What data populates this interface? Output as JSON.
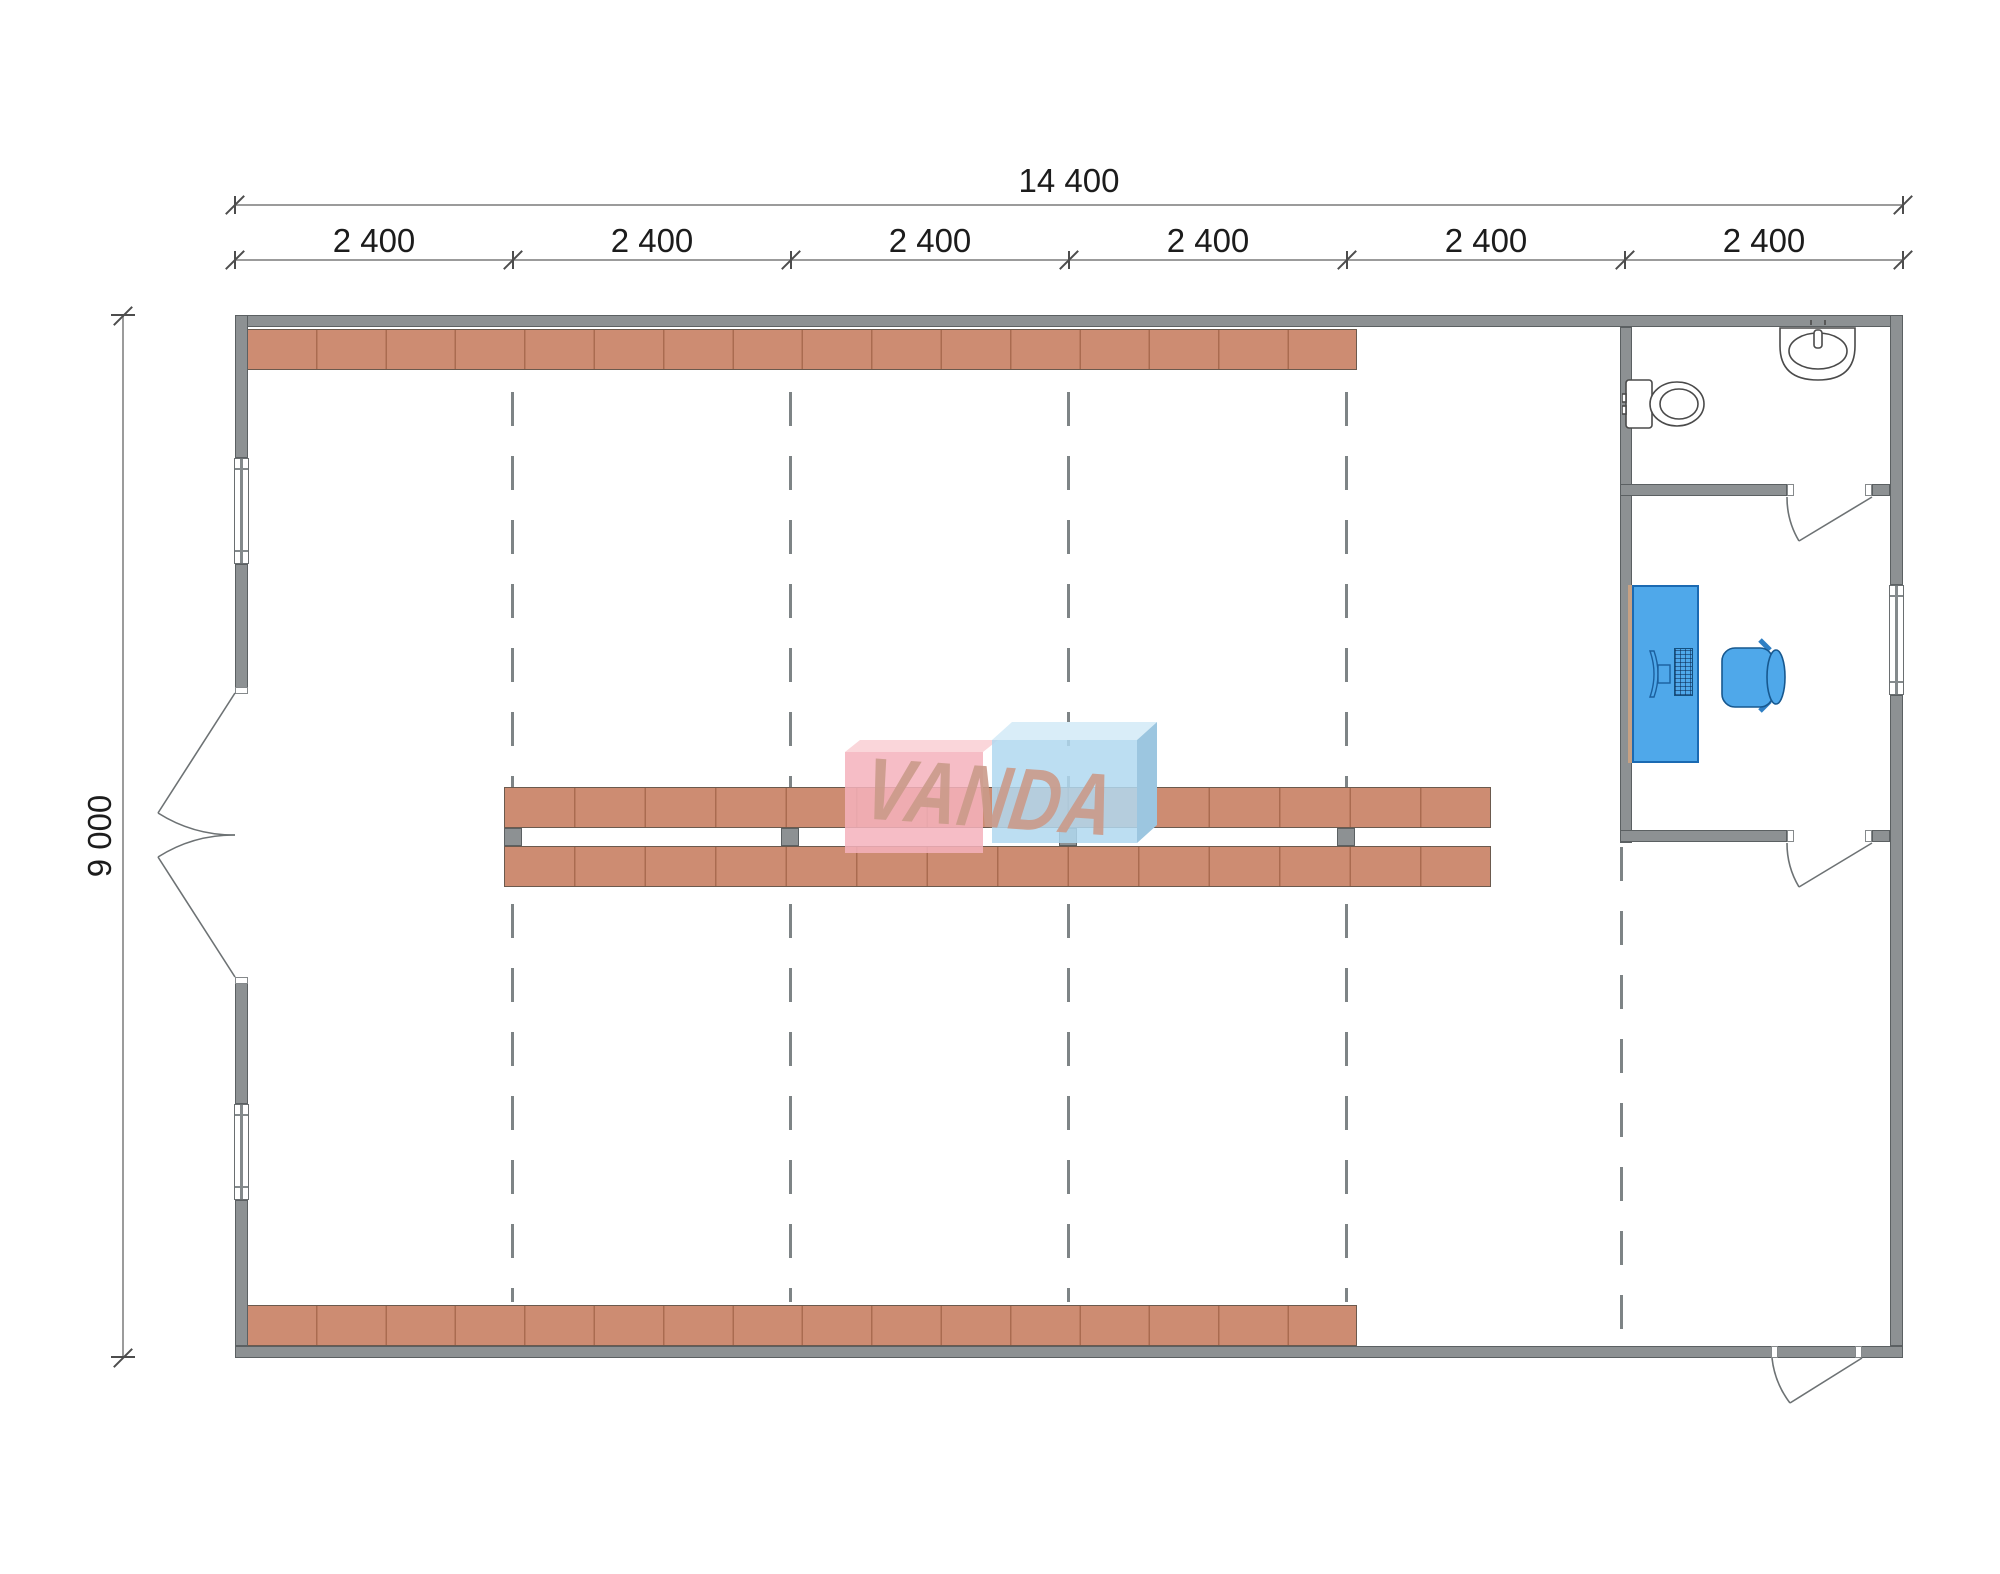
{
  "drawing": {
    "type": "floor-plan",
    "units_note": "dimension labels as shown on screen"
  },
  "dimensions": {
    "total_width_label": "14 400",
    "height_label": "9 000",
    "bays": [
      "2 400",
      "2 400",
      "2 400",
      "2 400",
      "2 400",
      "2 400"
    ]
  },
  "watermark": {
    "text": "VANDA",
    "text_color": "rgba(202,154,138,0.9)",
    "pink_front": "rgba(244,178,188,0.85)",
    "pink_top": "#fad6da",
    "blue_front": "rgba(176,216,240,0.85)",
    "blue_top": "#d9edf8",
    "blue_side": "#9cc6e0"
  },
  "colors": {
    "wall": "#8d9193",
    "wall_border": "#5b6062",
    "shelf": "#cd8c72",
    "shelf_divider": "#aa6b50",
    "desk_blue": "#4fa8ea",
    "desk_border": "#1b6ab2",
    "grid_dash": "#7e8486",
    "dimension_line": "#9b9b9b",
    "dimension_text": "#1c1c1c"
  },
  "fixtures": {
    "toilet": "toilet-icon",
    "sink": "sink-icon",
    "desk": "office-desk",
    "chair": "office-chair-icon",
    "monitor": "monitor-icon",
    "keyboard": "keyboard-icon"
  }
}
